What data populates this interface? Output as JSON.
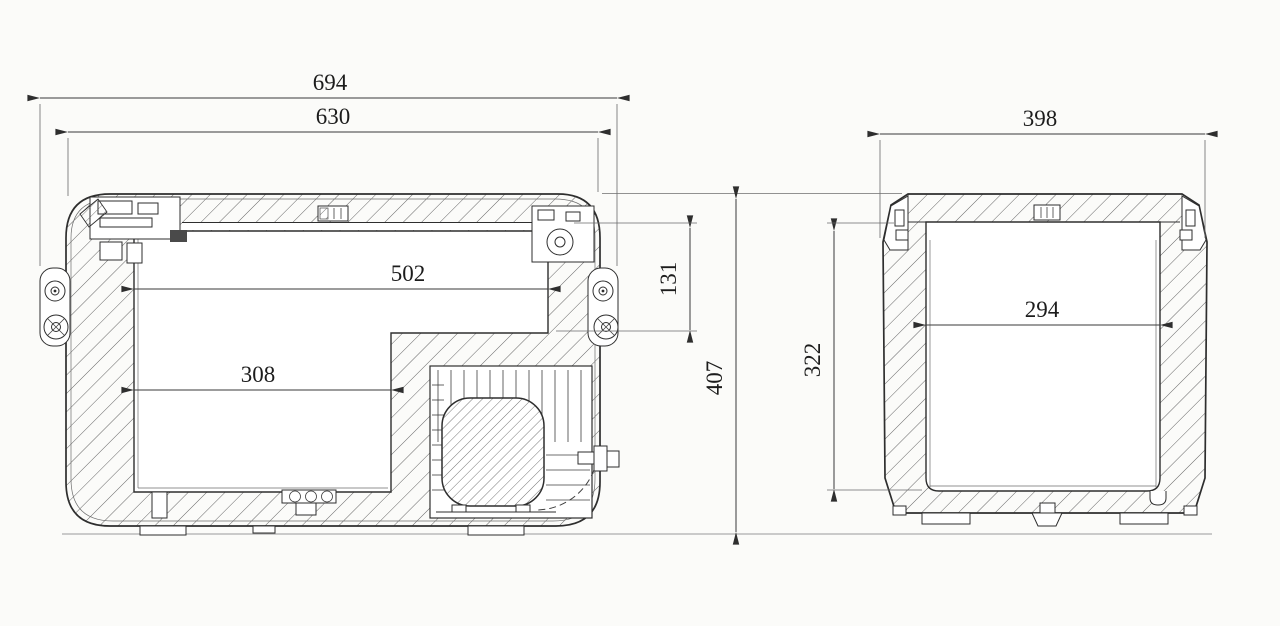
{
  "drawing": {
    "type": "technical-cross-section",
    "side_section": {
      "overall_width": "694",
      "lid_width": "630",
      "inner_length_top": "502",
      "inner_length_bottom": "308",
      "step_depth": "131",
      "overall_height": "407"
    },
    "end_section": {
      "overall_width": "398",
      "inner_width": "294",
      "inner_depth": "322"
    }
  },
  "colors": {
    "background": "#fbfbf9",
    "line": "#2e2e2e",
    "dimension_line": "#3a3a3a",
    "hatch": "#545454",
    "ground_line": "#9a9a9a"
  }
}
